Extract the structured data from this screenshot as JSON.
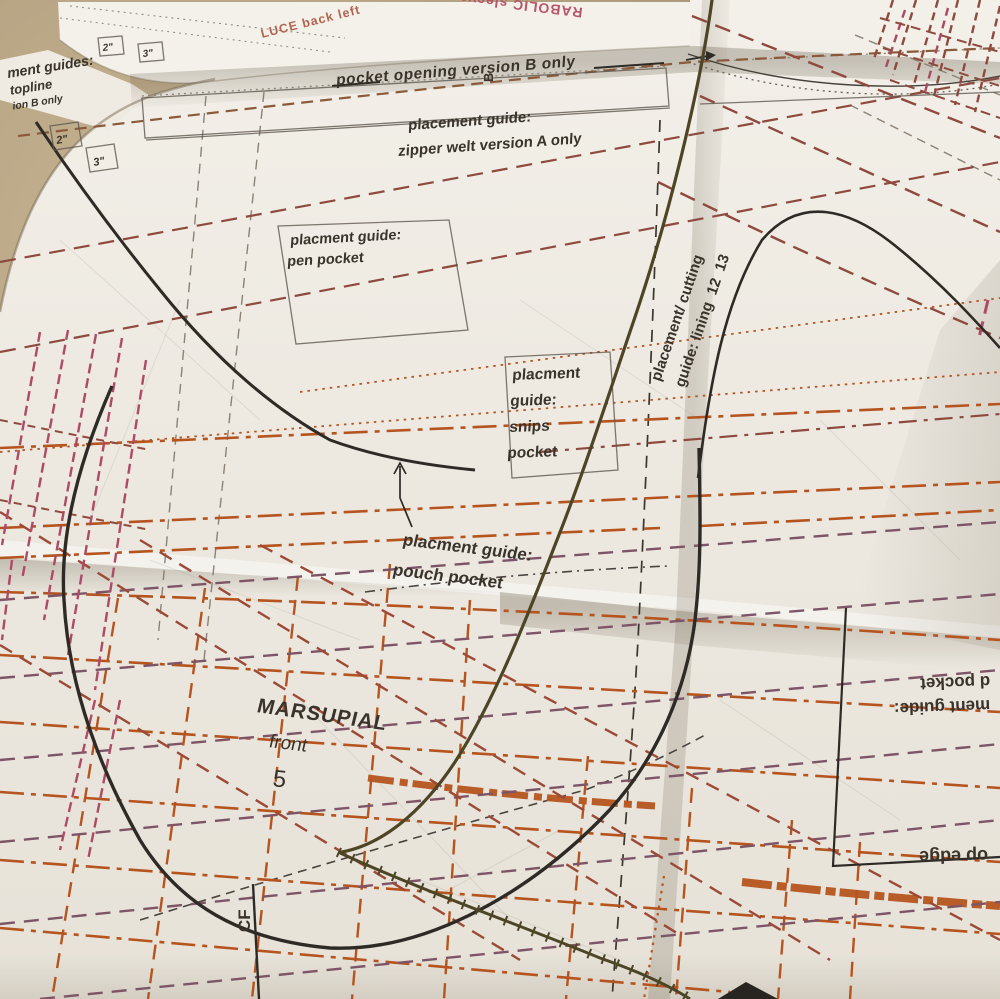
{
  "photo": {
    "subject": "folded sewing pattern sheet",
    "palette": {
      "background_tan": "#a89776",
      "paper": "#efebe3",
      "orange_guide": "#b5541f",
      "maroon_guide": "#8e4a3e",
      "purple_guide": "#7d5566",
      "magenta_hatch": "#ad4b66",
      "olive_thread": "#4c4526",
      "ink_black": "#35302a",
      "pink_label": "#b06551",
      "rose_label": "#b5566b"
    }
  },
  "labels": {
    "corner_1": "ment guides:",
    "corner_2": "topline",
    "corner_3": "ion B only",
    "luce": "LUCE back left",
    "parabolic": "RABOLIC sleeve",
    "pocket_opening": "pocket opening version B only",
    "marker_b": "B",
    "zipper_welt_1": "placement guide:",
    "zipper_welt_2": "zipper welt version A only",
    "pen_pocket_1": "placment guide:",
    "pen_pocket_2": "pen pocket",
    "snips_1": "placment",
    "snips_2": "guide:",
    "snips_3": "snips",
    "snips_4": "pocket",
    "pouch_1": "placment guide:",
    "pouch_2": "pouch pocket",
    "lining_1": "placement/ cutting",
    "lining_2": "guide: lining  12  13",
    "marsupial_name": "MARSUPIAL",
    "marsupial_sub": "front",
    "marsupial_size": "5",
    "cf": "CF",
    "card_pocket_1": "ment guide:",
    "card_pocket_2": "d pocket",
    "top_edge": "op edge",
    "scale_2in_a": "2\"",
    "scale_3in_a": "3\"",
    "scale_2in_b": "2\"",
    "scale_3in_b": "3\""
  }
}
